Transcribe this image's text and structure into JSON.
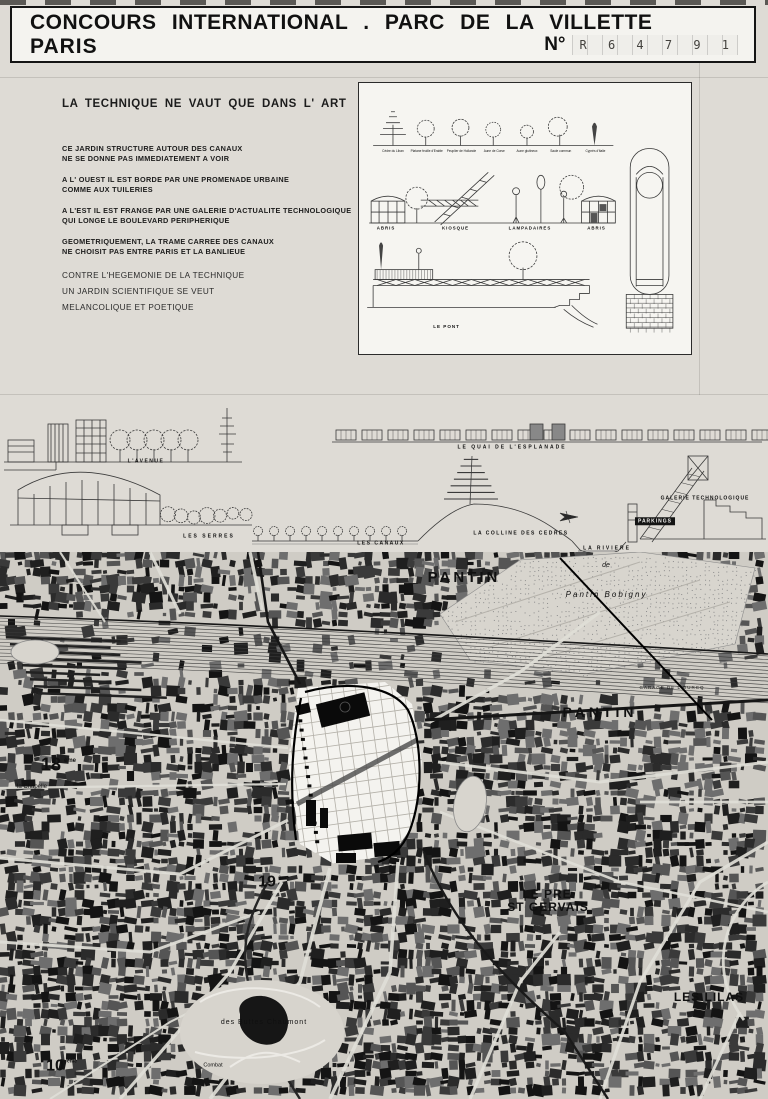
{
  "header": {
    "title_line1": "CONCOURS INTERNATIONAL . PARC DE LA VILLETTE",
    "title_line2": "PARIS",
    "number_prefix": "N°",
    "number_value": "R 6 4 7 9 1"
  },
  "manifesto": {
    "heading": "LA TECHNIQUE NE VAUT QUE DANS L' ART",
    "paragraphs": [
      "CE JARDIN STRUCTURE AUTOUR DES CANAUX\nNE SE DONNE PAS IMMEDIATEMENT A VOIR",
      "A L' OUEST IL EST BORDE PAR UNE PROMENADE URBAINE\nCOMME AUX TUILERIES",
      "A L'EST IL EST FRANGE PAR UNE GALERIE D'ACTUALITE TECHNOLOGIQUE\nQUI LONGE LE BOULEVARD PERIPHERIQUE",
      "GEOMETRIQUEMENT, LA TRAME CARREE DES CANAUX\nNE CHOISIT PAS ENTRE PARIS ET LA BANLIEUE"
    ],
    "closing_lines": [
      "CONTRE L'HEGEMONIE DE LA TECHNIQUE",
      "UN JARDIN SCIENTIFIQUE SE VEUT",
      "MELANCOLIQUE ET POETIQUE"
    ]
  },
  "detail_panel": {
    "labels": [
      {
        "text": "Cèdre du Liban",
        "x": 34,
        "y": 67,
        "size": 3.2
      },
      {
        "text": "Platane feuille d'Erable",
        "x": 68,
        "y": 67,
        "size": 3.2
      },
      {
        "text": "Peuplier de Hollande",
        "x": 103,
        "y": 67,
        "size": 3.2
      },
      {
        "text": "Aune de Corse",
        "x": 136,
        "y": 67,
        "size": 3.2
      },
      {
        "text": "Aune glutineux",
        "x": 169,
        "y": 67,
        "size": 3.2
      },
      {
        "text": "Saule commun",
        "x": 203,
        "y": 67,
        "size": 3.2
      },
      {
        "text": "Cyprès d'Italie",
        "x": 238,
        "y": 67,
        "size": 3.2
      },
      {
        "text": "ABRIS",
        "x": 27,
        "y": 144,
        "size": 4.4,
        "bold": true,
        "ls": 1
      },
      {
        "text": "KIOSQUE",
        "x": 97,
        "y": 144,
        "size": 4.4,
        "bold": true,
        "ls": 1
      },
      {
        "text": "LAMPADAIRES",
        "x": 172,
        "y": 144,
        "size": 4.4,
        "bold": true,
        "ls": 1
      },
      {
        "text": "ABRIS",
        "x": 239,
        "y": 144,
        "size": 4.4,
        "bold": true,
        "ls": 1
      },
      {
        "text": "LE PONT",
        "x": 88,
        "y": 243,
        "size": 4.6,
        "bold": true,
        "ls": 1
      }
    ]
  },
  "sections": {
    "labels": [
      {
        "text": "L'AVENUE",
        "x": 146,
        "y": 58,
        "size": 5,
        "bold": true,
        "ls": 1.5
      },
      {
        "text": "LE QUAI DE L'ESPLANADE",
        "x": 512,
        "y": 44,
        "size": 5,
        "bold": true,
        "ls": 2
      },
      {
        "text": "LES SERRES",
        "x": 209,
        "y": 133,
        "size": 5,
        "bold": true,
        "ls": 2
      },
      {
        "text": "LES CANAUX",
        "x": 381,
        "y": 140,
        "size": 5,
        "bold": true,
        "ls": 1.5
      },
      {
        "text": "LA COLLINE DES CEDRES",
        "x": 521,
        "y": 130,
        "size": 5,
        "bold": true,
        "ls": 1.5
      },
      {
        "text": "LA RIVIERE",
        "x": 607,
        "y": 145,
        "size": 5,
        "bold": true,
        "ls": 2
      },
      {
        "text": "GALERIE TECHNOLOGIQUE",
        "x": 705,
        "y": 95,
        "size": 5,
        "bold": true,
        "ls": 1
      },
      {
        "text": "PARKINGS",
        "x": 655,
        "y": 118,
        "size": 5,
        "bold": true,
        "ls": 1,
        "inv": true
      }
    ]
  },
  "map": {
    "labels": [
      {
        "text": "PANTIN",
        "x": 464,
        "y": 17,
        "size": 15,
        "bold": true,
        "ls": 3
      },
      {
        "text": "de",
        "x": 606,
        "y": 9,
        "size": 7,
        "italic": true
      },
      {
        "text": "Pantin",
        "x": 583,
        "y": 38,
        "size": 8,
        "italic": true,
        "ls": 2
      },
      {
        "text": "Bobigny",
        "x": 626,
        "y": 38,
        "size": 8,
        "italic": true,
        "ls": 2
      },
      {
        "text": "GARAGE DE L'OURCQ",
        "x": 672,
        "y": 133,
        "size": 4.5,
        "ls": 1
      },
      {
        "text": "PANTIN",
        "x": 600,
        "y": 153,
        "size": 14,
        "bold": true,
        "ls": 4
      },
      {
        "text": "18",
        "x": 51,
        "y": 203,
        "size": 18,
        "bold": true
      },
      {
        "text": "ème",
        "x": 70,
        "y": 205,
        "size": 6,
        "bold": true
      },
      {
        "text": "la Chapelle",
        "x": 32,
        "y": 231,
        "size": 6
      },
      {
        "text": "19",
        "x": 267,
        "y": 321,
        "size": 16,
        "bold": true
      },
      {
        "text": "ème",
        "x": 284,
        "y": 323,
        "size": 5.5,
        "bold": true
      },
      {
        "text": "LE PRE",
        "x": 547,
        "y": 336,
        "size": 12,
        "bold": true,
        "ls": 1
      },
      {
        "text": "ST GERVAIS",
        "x": 548,
        "y": 349,
        "size": 12,
        "bold": true,
        "ls": 1
      },
      {
        "text": "LES LILAS",
        "x": 709,
        "y": 439,
        "size": 12,
        "bold": true,
        "ls": 1
      },
      {
        "text": "des Buttes Chaumont",
        "x": 264,
        "y": 466,
        "size": 7,
        "ls": 1
      },
      {
        "text": "10",
        "x": 55,
        "y": 505,
        "size": 16,
        "bold": true
      },
      {
        "text": "ème",
        "x": 72,
        "y": 506,
        "size": 5,
        "bold": true
      },
      {
        "text": "Combat",
        "x": 213,
        "y": 510,
        "size": 5.5
      }
    ]
  },
  "colors": {
    "paper": "#dedbd5",
    "panel_bg": "#f6f5f1",
    "ink": "#161616",
    "map_bg": "#cfccc5",
    "site_white": "#f4f3ef"
  }
}
